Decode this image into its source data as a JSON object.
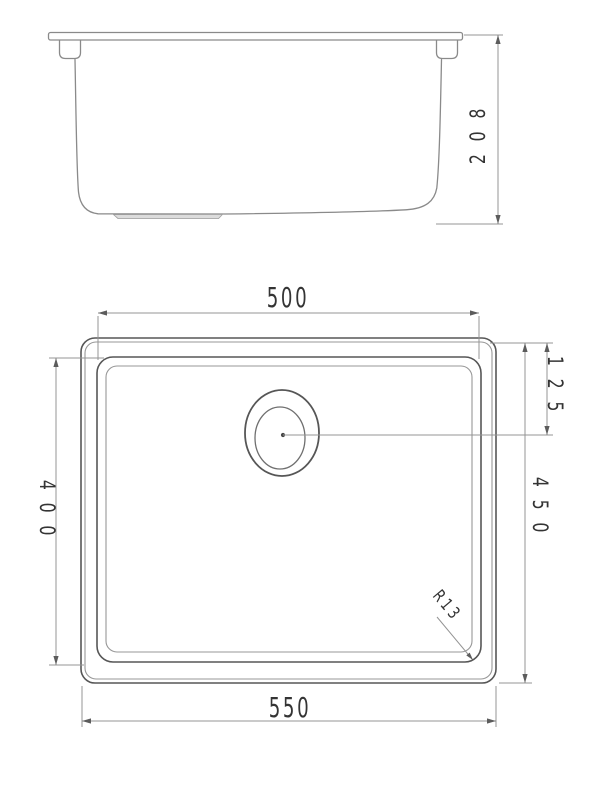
{
  "drawing": {
    "side_view": {
      "height_label": "208"
    },
    "top_view": {
      "bowl_width_label": "500",
      "overall_width_label": "550",
      "bowl_depth_label": "400",
      "overall_depth_label": "450",
      "drain_offset_label": "125",
      "corner_radius_label": "R13"
    },
    "colors": {
      "outline": "#565656",
      "secondary_line": "#979797",
      "side_view_line": "#8a8a8a",
      "dimension_line": "#949494",
      "label_text": "#343434",
      "background": "#ffffff"
    }
  }
}
